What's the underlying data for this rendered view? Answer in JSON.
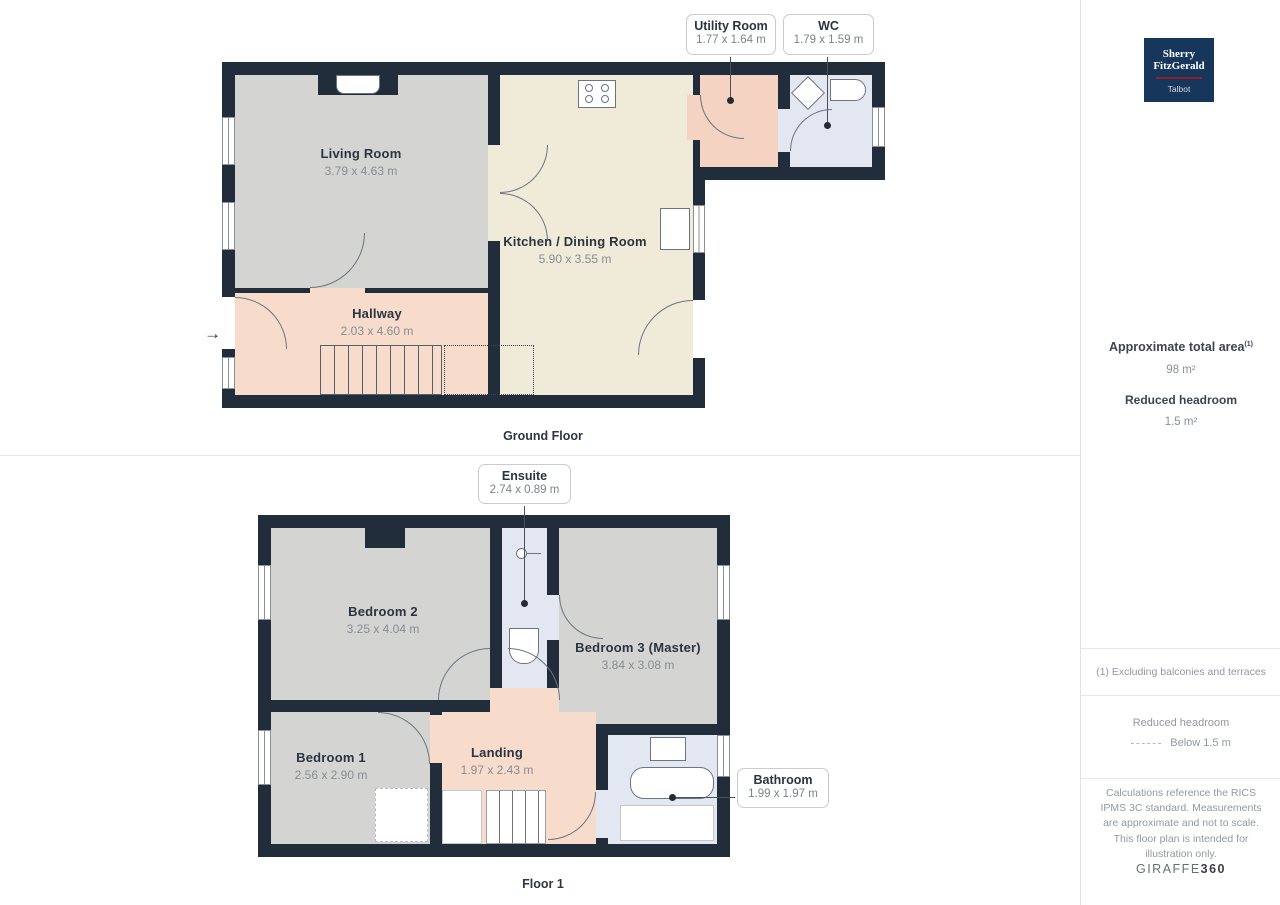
{
  "floors": [
    {
      "caption": "Ground Floor",
      "rooms": [
        {
          "name": "Living Room",
          "dims": "3.79 x 4.63 m"
        },
        {
          "name": "Kitchen / Dining Room",
          "dims": "5.90 x 3.55 m"
        },
        {
          "name": "Hallway",
          "dims": "2.03 x 4.60 m"
        }
      ],
      "callouts": [
        {
          "name": "Utility Room",
          "dims": "1.77 x 1.64 m"
        },
        {
          "name": "WC",
          "dims": "1.79 x 1.59 m"
        }
      ]
    },
    {
      "caption": "Floor 1",
      "rooms": [
        {
          "name": "Bedroom 2",
          "dims": "3.25 x 4.04 m"
        },
        {
          "name": "Bedroom 3 (Master)",
          "dims": "3.84 x 3.08 m"
        },
        {
          "name": "Bedroom 1",
          "dims": "2.56 x 2.90 m"
        },
        {
          "name": "Landing",
          "dims": "1.97 x 2.43 m"
        }
      ],
      "callouts": [
        {
          "name": "Ensuite",
          "dims": "2.74 x 0.89 m"
        },
        {
          "name": "Bathroom",
          "dims": "1.99 x 1.97 m"
        }
      ]
    }
  ],
  "plan": {
    "entrance_arrow": "→"
  },
  "sidebar": {
    "logo": {
      "line1": "Sherry",
      "line2": "FitzGerald",
      "subtitle": "Talbot",
      "bg": "#16365c",
      "accent": "#8f1f2e"
    },
    "area": {
      "title": "Approximate total area",
      "superscript": "(1)",
      "value": "98 m²",
      "headroom_title": "Reduced headroom",
      "headroom_value": "1.5 m²"
    },
    "footnote": "(1) Excluding balconies and terraces",
    "legend": {
      "title": "Reduced headroom",
      "label": "Below 1.5 m"
    },
    "disclaimer": "Calculations reference the RICS IPMS 3C standard. Measurements are approximate and not to scale. This floor plan is intended for illustration only.",
    "brand": {
      "regular": "GIRAFFE",
      "bold": "360"
    }
  },
  "colors": {
    "wall": "#212d3b",
    "room_gray": "#d4d4d2",
    "room_cream": "#f0ebd8",
    "room_salmon": "#f7dbcb",
    "room_utility": "#f5d3c2",
    "room_blue": "#e3e7f1",
    "logo_bg": "#16365c",
    "logo_accent": "#8f1f2e"
  }
}
